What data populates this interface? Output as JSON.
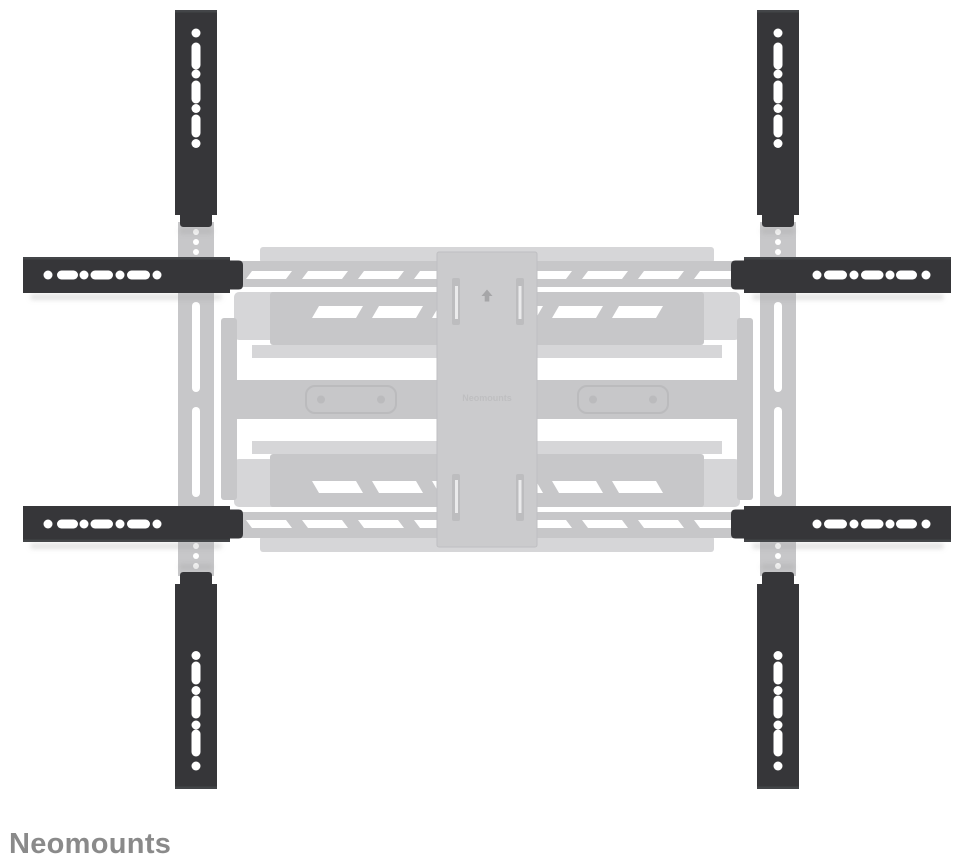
{
  "brand": {
    "name": "Neomounts",
    "watermark": "Neomounts"
  },
  "illustration": {
    "subject": "TV wall mount VESA extension kit",
    "vertical_strips": [
      "top-left",
      "top-right",
      "bottom-left",
      "bottom-right"
    ],
    "horizontal_strips": [
      "left-top",
      "right-top",
      "left-bottom",
      "right-bottom"
    ],
    "ghost_part": "full-motion wall mount shown ghosted in gray",
    "icons": {
      "plate_arrow": "up-arrow"
    }
  },
  "colors": {
    "background": "#ffffff",
    "extension_bar": "#363639",
    "bar_highlight": "#55585a",
    "hole": "#ffffff",
    "ghost_light": "#c7c7c9",
    "ghost_lighter": "#d6d6d8",
    "ghost_plate": "#cbcbcd",
    "ghost_detail": "#b2b2b5",
    "shadow": "#9a9a9a",
    "brand_text": "#8a8a8a",
    "watermark": "#bdbdbf",
    "arrow": "#a6a6a8"
  }
}
